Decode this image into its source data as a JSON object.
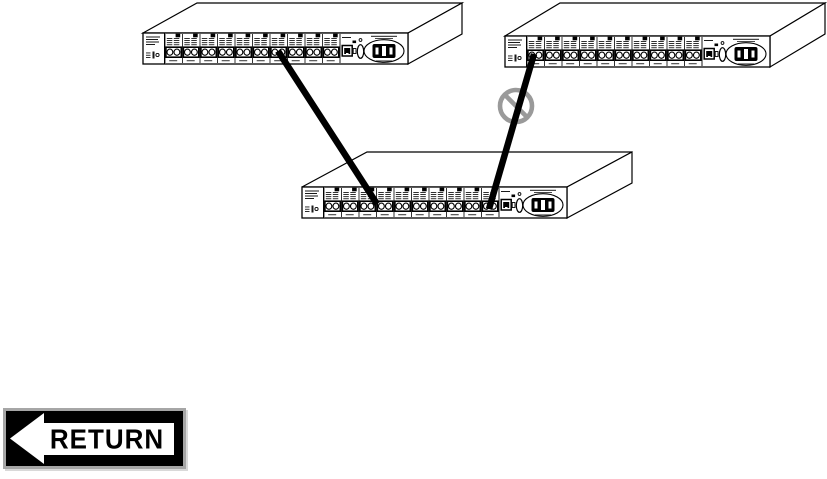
{
  "page": {
    "background": "#ffffff"
  },
  "diagram": {
    "devices": [
      {
        "id": "hub-top-left",
        "port_modules": 10,
        "ports_per_module": 2
      },
      {
        "id": "hub-top-right",
        "port_modules": 10,
        "ports_per_module": 2
      },
      {
        "id": "hub-bottom-center",
        "port_modules": 10,
        "ports_per_module": 2
      }
    ],
    "connections": [
      {
        "id": "cable-left",
        "from": "hub-top-left",
        "to": "hub-bottom-center",
        "allowed": true
      },
      {
        "id": "cable-right",
        "from": "hub-top-right",
        "to": "hub-bottom-center",
        "allowed": false
      }
    ],
    "prohibition_icon": {
      "name": "no-symbol-icon",
      "color": "#9a9a9a"
    },
    "colors": {
      "outline": "#000000",
      "cable": "#000000",
      "panel": "#ffffff",
      "marks": "#1a1a1a"
    }
  },
  "return_button": {
    "label": "RETURN",
    "icon": "left-arrow-icon",
    "colors": {
      "background": "#000000",
      "border": "#a6a6a6",
      "label_box": "#ffffff",
      "label_text": "#000000",
      "arrow": "#ffffff"
    }
  }
}
